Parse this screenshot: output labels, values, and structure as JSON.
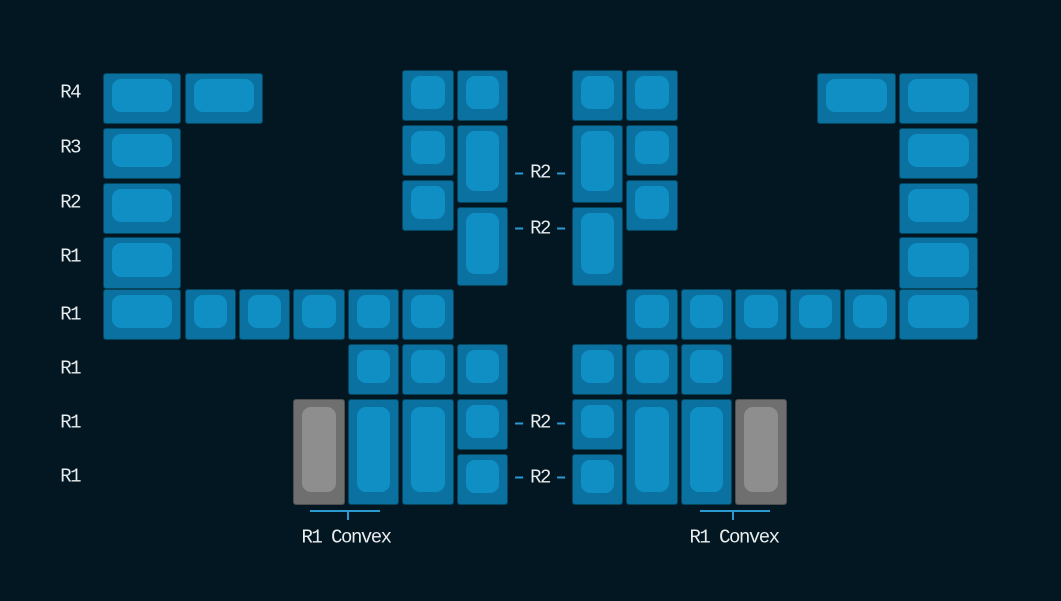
{
  "canvas": {
    "width": 1061,
    "height": 601,
    "background": "#031723"
  },
  "colors": {
    "background": "#031723",
    "key_blue_base": "#0B71A1",
    "key_blue_top": "#0F8FC4",
    "key_gray_base": "#6F6F6F",
    "key_gray_top": "#8E8E8E",
    "accent_line": "#2B9AD1",
    "label_text": "#E9EDEE"
  },
  "row_labels": [
    {
      "text": "R4",
      "anchor_x": 80,
      "y": 93
    },
    {
      "text": "R3",
      "anchor_x": 80,
      "y": 147.8
    },
    {
      "text": "R2",
      "anchor_x": 80,
      "y": 202.6
    },
    {
      "text": "R1",
      "anchor_x": 80,
      "y": 257.4
    },
    {
      "text": "R1",
      "anchor_x": 80,
      "y": 314.5
    },
    {
      "text": "R1",
      "anchor_x": 80,
      "y": 368.5
    },
    {
      "text": "R1",
      "anchor_x": 80,
      "y": 423.0
    },
    {
      "text": "R1",
      "anchor_x": 80,
      "y": 477.0
    }
  ],
  "profile_labels": [
    {
      "text": "R2",
      "x": 540,
      "y": 173
    },
    {
      "text": "R2",
      "x": 540,
      "y": 228.5
    },
    {
      "text": "R2",
      "x": 540,
      "y": 423
    },
    {
      "text": "R2",
      "x": 540,
      "y": 477.5
    }
  ],
  "brackets": [
    {
      "label": "R1 Convex",
      "x1": 310,
      "x2": 380,
      "y": 510,
      "tick_x": 347.5,
      "tick_len": 10,
      "label_x": 346,
      "label_y": 538
    },
    {
      "label": "R1 Convex",
      "x1": 700,
      "x2": 770,
      "y": 510,
      "tick_x": 732.5,
      "tick_len": 10,
      "label_x": 734,
      "label_y": 538
    }
  ],
  "keys": [
    {
      "x": 102.7,
      "y": 73.0,
      "w": 78.6,
      "h": 51.3,
      "color": "blue",
      "name": "left-outer-r4-1.5u"
    },
    {
      "x": 184.5,
      "y": 73.0,
      "w": 78.6,
      "h": 51.3,
      "color": "blue",
      "name": "left-r4-1.5u"
    },
    {
      "x": 402.4,
      "y": 70.0,
      "w": 51.3,
      "h": 51.3,
      "color": "blue",
      "name": "left-inner-r4-a"
    },
    {
      "x": 456.9,
      "y": 70.0,
      "w": 51.3,
      "h": 51.3,
      "color": "blue",
      "name": "left-inner-r4-b"
    },
    {
      "x": 102.7,
      "y": 127.8,
      "w": 78.6,
      "h": 51.3,
      "color": "blue",
      "name": "left-outer-r3-1.5u"
    },
    {
      "x": 402.4,
      "y": 124.8,
      "w": 51.3,
      "h": 51.3,
      "color": "blue",
      "name": "left-inner-r3"
    },
    {
      "x": 456.9,
      "y": 124.8,
      "w": 51.3,
      "h": 78.7,
      "color": "blue",
      "name": "left-inner-tall-a"
    },
    {
      "x": 102.7,
      "y": 182.6,
      "w": 78.6,
      "h": 51.3,
      "color": "blue",
      "name": "left-outer-r2-1.5u"
    },
    {
      "x": 402.4,
      "y": 179.6,
      "w": 51.3,
      "h": 51.3,
      "color": "blue",
      "name": "left-inner-r2"
    },
    {
      "x": 456.9,
      "y": 207.0,
      "w": 51.3,
      "h": 78.7,
      "color": "blue",
      "name": "left-inner-tall-b"
    },
    {
      "x": 102.7,
      "y": 237.4,
      "w": 78.6,
      "h": 51.3,
      "color": "blue",
      "name": "left-outer-r1-1.5u"
    },
    {
      "x": 102.7,
      "y": 289.2,
      "w": 78.6,
      "h": 51.3,
      "color": "blue",
      "name": "left-bottomrow-1.5u"
    },
    {
      "x": 184.5,
      "y": 289.2,
      "w": 51.3,
      "h": 51.3,
      "color": "blue",
      "name": "left-bottomrow-1"
    },
    {
      "x": 239.0,
      "y": 289.2,
      "w": 51.3,
      "h": 51.3,
      "color": "blue",
      "name": "left-bottomrow-2"
    },
    {
      "x": 293.4,
      "y": 289.2,
      "w": 51.3,
      "h": 51.3,
      "color": "blue",
      "name": "left-bottomrow-3"
    },
    {
      "x": 347.9,
      "y": 289.2,
      "w": 51.3,
      "h": 51.3,
      "color": "blue",
      "name": "left-bottomrow-4"
    },
    {
      "x": 402.4,
      "y": 289.2,
      "w": 51.3,
      "h": 51.3,
      "color": "blue",
      "name": "left-bottomrow-5"
    },
    {
      "x": 347.9,
      "y": 344.0,
      "w": 51.3,
      "h": 51.3,
      "color": "blue",
      "name": "left-thumb-top-1"
    },
    {
      "x": 402.4,
      "y": 344.0,
      "w": 51.3,
      "h": 51.3,
      "color": "blue",
      "name": "left-thumb-top-2"
    },
    {
      "x": 456.9,
      "y": 344.0,
      "w": 51.3,
      "h": 51.3,
      "color": "blue",
      "name": "left-thumb-top-3"
    },
    {
      "x": 293.4,
      "y": 398.8,
      "w": 51.3,
      "h": 106.1,
      "color": "gray",
      "name": "left-thumb-2u-gray"
    },
    {
      "x": 347.9,
      "y": 398.8,
      "w": 51.3,
      "h": 106.1,
      "color": "blue",
      "name": "left-thumb-2u-a"
    },
    {
      "x": 402.4,
      "y": 398.8,
      "w": 51.3,
      "h": 106.1,
      "color": "blue",
      "name": "left-thumb-2u-b"
    },
    {
      "x": 456.9,
      "y": 398.8,
      "w": 51.3,
      "h": 51.3,
      "color": "blue",
      "name": "left-thumb-mid"
    },
    {
      "x": 456.9,
      "y": 453.6,
      "w": 51.3,
      "h": 51.3,
      "color": "blue",
      "name": "left-thumb-low"
    },
    {
      "x": 571.8,
      "y": 70.0,
      "w": 51.3,
      "h": 51.3,
      "color": "blue",
      "name": "right-inner-r4-a"
    },
    {
      "x": 626.3,
      "y": 70.0,
      "w": 51.3,
      "h": 51.3,
      "color": "blue",
      "name": "right-inner-r4-b"
    },
    {
      "x": 817.3,
      "y": 73.0,
      "w": 78.6,
      "h": 51.3,
      "color": "blue",
      "name": "right-r4-1.5u"
    },
    {
      "x": 899.0,
      "y": 73.0,
      "w": 78.6,
      "h": 51.3,
      "color": "blue",
      "name": "right-outer-r4-1.5u"
    },
    {
      "x": 571.8,
      "y": 124.8,
      "w": 51.3,
      "h": 78.7,
      "color": "blue",
      "name": "right-inner-tall-a"
    },
    {
      "x": 626.3,
      "y": 124.8,
      "w": 51.3,
      "h": 51.3,
      "color": "blue",
      "name": "right-inner-r3"
    },
    {
      "x": 899.0,
      "y": 127.8,
      "w": 78.6,
      "h": 51.3,
      "color": "blue",
      "name": "right-outer-r3-1.5u"
    },
    {
      "x": 571.8,
      "y": 207.0,
      "w": 51.3,
      "h": 78.7,
      "color": "blue",
      "name": "right-inner-tall-b"
    },
    {
      "x": 626.3,
      "y": 179.6,
      "w": 51.3,
      "h": 51.3,
      "color": "blue",
      "name": "right-inner-r2"
    },
    {
      "x": 899.0,
      "y": 182.6,
      "w": 78.6,
      "h": 51.3,
      "color": "blue",
      "name": "right-outer-r2-1.5u"
    },
    {
      "x": 899.0,
      "y": 237.4,
      "w": 78.6,
      "h": 51.3,
      "color": "blue",
      "name": "right-outer-r1-1.5u"
    },
    {
      "x": 626.3,
      "y": 289.2,
      "w": 51.3,
      "h": 51.3,
      "color": "blue",
      "name": "right-bottomrow-1"
    },
    {
      "x": 680.8,
      "y": 289.2,
      "w": 51.3,
      "h": 51.3,
      "color": "blue",
      "name": "right-bottomrow-2"
    },
    {
      "x": 735.3,
      "y": 289.2,
      "w": 51.3,
      "h": 51.3,
      "color": "blue",
      "name": "right-bottomrow-3"
    },
    {
      "x": 789.8,
      "y": 289.2,
      "w": 51.3,
      "h": 51.3,
      "color": "blue",
      "name": "right-bottomrow-4"
    },
    {
      "x": 844.3,
      "y": 289.2,
      "w": 51.3,
      "h": 51.3,
      "color": "blue",
      "name": "right-bottomrow-5"
    },
    {
      "x": 899.0,
      "y": 289.2,
      "w": 78.6,
      "h": 51.3,
      "color": "blue",
      "name": "right-bottomrow-1.5u"
    },
    {
      "x": 571.8,
      "y": 344.0,
      "w": 51.3,
      "h": 51.3,
      "color": "blue",
      "name": "right-thumb-top-1"
    },
    {
      "x": 626.3,
      "y": 344.0,
      "w": 51.3,
      "h": 51.3,
      "color": "blue",
      "name": "right-thumb-top-2"
    },
    {
      "x": 680.8,
      "y": 344.0,
      "w": 51.3,
      "h": 51.3,
      "color": "blue",
      "name": "right-thumb-top-3"
    },
    {
      "x": 571.8,
      "y": 398.8,
      "w": 51.3,
      "h": 51.3,
      "color": "blue",
      "name": "right-thumb-mid"
    },
    {
      "x": 571.8,
      "y": 453.6,
      "w": 51.3,
      "h": 51.3,
      "color": "blue",
      "name": "right-thumb-low"
    },
    {
      "x": 626.3,
      "y": 398.8,
      "w": 51.3,
      "h": 106.1,
      "color": "blue",
      "name": "right-thumb-2u-a"
    },
    {
      "x": 680.8,
      "y": 398.8,
      "w": 51.3,
      "h": 106.1,
      "color": "blue",
      "name": "right-thumb-2u-b"
    },
    {
      "x": 735.3,
      "y": 398.8,
      "w": 51.3,
      "h": 106.1,
      "color": "gray",
      "name": "right-thumb-2u-gray"
    }
  ]
}
